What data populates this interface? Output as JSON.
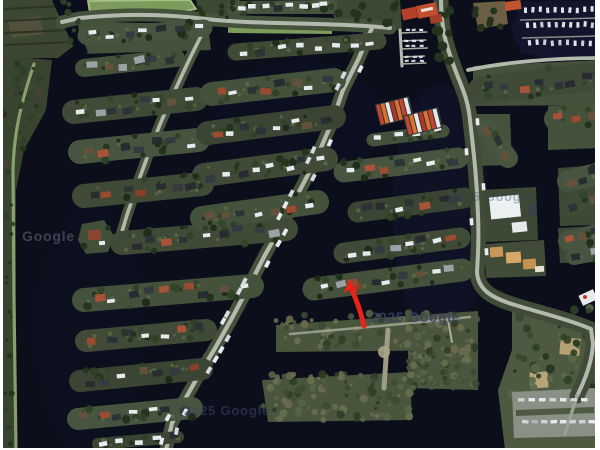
{
  "title": "Satellite view of canal-side holiday park with marina",
  "watermarks": {
    "left": {
      "text": "Google"
    },
    "center": {
      "text": "2025 Google"
    },
    "bottom": {
      "text": "2025 Google"
    },
    "right": {
      "text": "2025 Google"
    }
  },
  "annotation": {
    "type": "arrow",
    "color": "#e8231a",
    "points_at": "waterfront house on peninsula row"
  },
  "colors": {
    "water": "#0c0e1b",
    "water_light": "#11142a",
    "basin": "#12152c",
    "land": "#414d38",
    "land_dark": "#38442f",
    "grass_light": "#5d6c49",
    "bright_field": "#7d9b5b",
    "field_border": "#a9bf85",
    "scrub": "#49553c",
    "dike": "#8fa46d",
    "road": "#b4b9ae",
    "road_dim": "#9aa095",
    "parking": "#8e948a",
    "tree": "#24331d",
    "house_dark": "#2c3337",
    "house_light": "#9aa2a6",
    "house_red": "#9c4a30",
    "house_brown": "#64513c",
    "caravan_white": "#e7ebee",
    "beige": "#cda368",
    "boat": "#dde4ea",
    "marina_red": "#c24e2f",
    "frame": "#ffffff"
  }
}
